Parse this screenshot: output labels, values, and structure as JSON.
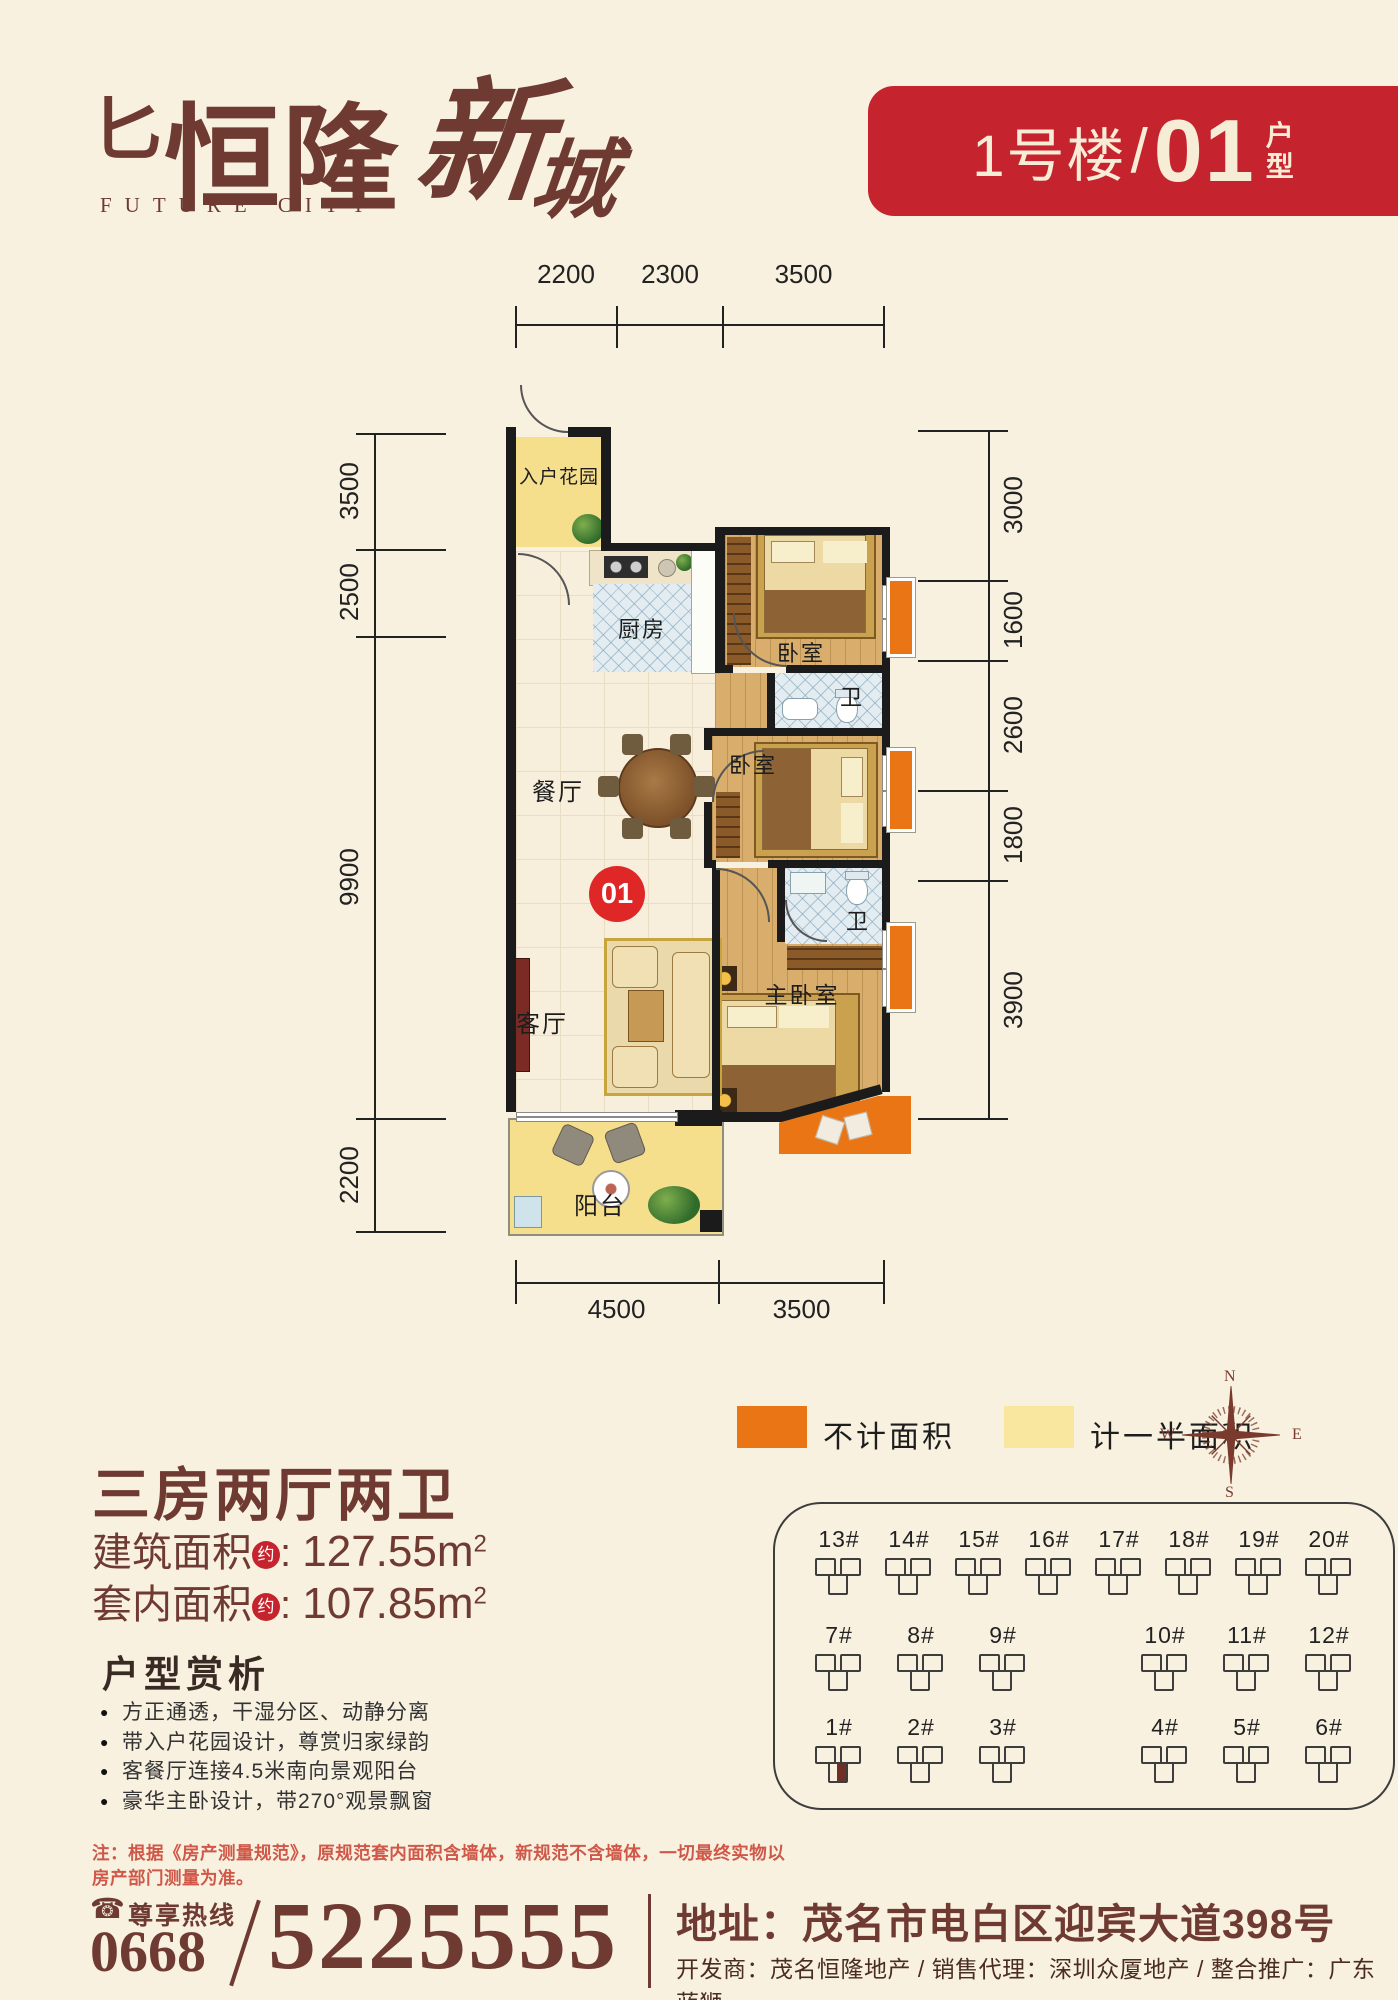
{
  "header": {
    "logo": {
      "mark": "⼔",
      "main": "恒隆",
      "script1": "新",
      "script2": "城",
      "en": "FUTURE CITY"
    },
    "banner": {
      "building": "1号楼",
      "slash": "/",
      "unit": "01",
      "suffix_top": "户",
      "suffix_bottom": "型"
    }
  },
  "floorplan": {
    "rooms": {
      "garden": "入户花园",
      "kitchen": "厨房",
      "bedroom_top": "卧室",
      "bath_top": "卫",
      "bedroom_mid": "卧室",
      "bath_mid": "卫",
      "master": "主卧室",
      "dining": "餐厅",
      "living": "客厅",
      "balcony": "阳台"
    },
    "unit_badge": "01",
    "dims": {
      "top": [
        "2200",
        "2300",
        "3500"
      ],
      "left": [
        "3500",
        "2500",
        "9900",
        "2200"
      ],
      "right": [
        "3000",
        "1600",
        "2600",
        "1800",
        "3900"
      ],
      "bottom": [
        "4500",
        "3500"
      ]
    }
  },
  "legend": {
    "items": [
      {
        "label": "不计面积",
        "color": "#ea7514"
      },
      {
        "label": "计一半面积",
        "color": "#f9e7a0"
      }
    ]
  },
  "compass": {
    "n": "N",
    "e": "E",
    "s": "S",
    "w": "W"
  },
  "summary": {
    "title": "三房两厅两卫",
    "lines": [
      {
        "label": "建筑面积",
        "seal": "约",
        "sep": ":",
        "value": "127.55",
        "unit": "m",
        "sup": "2"
      },
      {
        "label": "套内面积",
        "seal": "约",
        "sep": ":",
        "value": "107.85",
        "unit": "m",
        "sup": "2"
      }
    ]
  },
  "analysis": {
    "title": "户型赏析",
    "bullets": [
      "方正通透，干湿分区、动静分离",
      "带入户花园设计，尊赏归家绿韵",
      "客餐厅连接4.5米南向景观阳台",
      "豪华主卧设计，带270°观景飘窗"
    ]
  },
  "note": "注：根据《房产测量规范》，原规范套内面积含墙体，新规范不含墙体，一切最终实物以房产部门测量为准。",
  "sitemap": {
    "rows": {
      "r1": [
        "13#",
        "14#",
        "15#",
        "16#",
        "17#",
        "18#",
        "19#",
        "20#"
      ],
      "r2": [
        "7#",
        "8#",
        "9#",
        "10#",
        "11#",
        "12#"
      ],
      "r3": [
        "1#",
        "2#",
        "3#",
        "4#",
        "5#",
        "6#"
      ]
    },
    "highlighted": "1#"
  },
  "footer": {
    "phone_icon": "☎",
    "hotline_label": "尊享热线",
    "area_code": "0668",
    "slash": "/",
    "number": "5225555",
    "address": "地址：茂名市电白区迎宾大道398号",
    "agencies": "开发商：茂名恒隆地产 / 销售代理：深圳众厦地产 / 整合推广：广东蓝狮"
  },
  "colors": {
    "background": "#f8f1e0",
    "brand_maroon": "#6e3a31",
    "banner_red": "#c5242e",
    "badge_red": "#e02727",
    "orange_no_area": "#ea7514",
    "yellow_half_area": "#f9e7a0",
    "garden_yellow": "#f6df8c",
    "note_red": "#cf5848"
  }
}
